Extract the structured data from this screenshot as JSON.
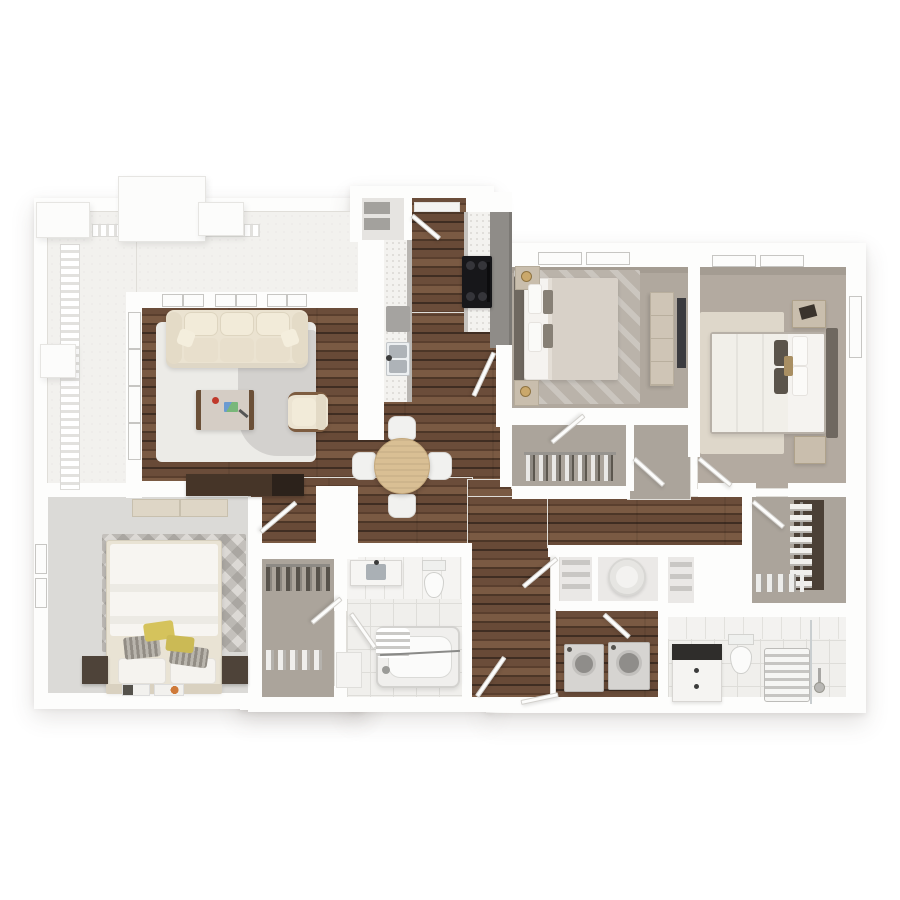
{
  "scene": {
    "title": "3D top-down apartment floor plan render",
    "type": "photoreal-3d-floorplan",
    "canvas": {
      "width": 900,
      "height": 900
    },
    "background": "#ffffff"
  },
  "palette": {
    "wall": "#fdfdfc",
    "wall_edge": "#e0ded9",
    "wood_floor_dark": "#4c3627",
    "wood_floor_mid": "#6b4d3a",
    "wood_floor_light": "#7a5a43",
    "carpet_warm": "#b0a89e",
    "carpet_warm2": "#b3aaa0",
    "carpet_light": "#dbdad7",
    "carpet_closet": "#aba49b",
    "balcony_floor": "#f2f1ee",
    "tile_floor": "#f0efec",
    "tile_line": "#deddd9",
    "accent_wall_gray": "#8f8c88",
    "closet_panel_dark": "#4b4036",
    "sofa_cream": "#ebe3d1",
    "armchair_cream": "#ece4d2",
    "table_wood": "#d9bf94",
    "chair_white": "#f1f1ef",
    "stove_black": "#17171a",
    "counter_white": "#f3f2ef",
    "tv_console_brown": "#463528",
    "bed_white": "#f5f3f0",
    "duvet_taupe": "#d8d1c8",
    "pillow_dark": "#5b544b",
    "pillow_yellow": "#d5c35c",
    "pillow_tan": "#a98f63",
    "nightstand_dark": "#4e4339",
    "nightstand_light": "#c9bead",
    "lamp_gold": "#caa86b",
    "appliance_gray": "#d6d4d1",
    "rug_cream": "#ded7ca",
    "rug_gray": "#bab3aa",
    "rug_living": "#ecebe7",
    "water_heater": "#f3f2f0",
    "door_leaf": "#fcfcfb"
  },
  "rooms": [
    {
      "id": "balcony",
      "name": "balcony",
      "features": [
        "railing",
        "pillars"
      ]
    },
    {
      "id": "living-room",
      "name": "living-room",
      "furniture": [
        "cream-sofa",
        "coffee-table",
        "armchair",
        "tv-console",
        "two-tone-rug"
      ],
      "features": [
        "three-windows-top",
        "tall-window-left"
      ]
    },
    {
      "id": "dining-area",
      "name": "dining-area",
      "furniture": [
        "round-wood-table",
        "four-white-chairs"
      ]
    },
    {
      "id": "kitchen",
      "name": "kitchen",
      "furniture": [
        "left-counter-with-sink",
        "dishwasher",
        "right-counter",
        "black-stove"
      ],
      "features": [
        "gray-accent-wall"
      ]
    },
    {
      "id": "entry",
      "name": "entry",
      "furniture": [
        "pantry-shelves",
        "door-mat"
      ]
    },
    {
      "id": "bedroom-1",
      "name": "bedroom-1",
      "furniture": [
        "queen-bed-taupe-duvet",
        "two-nightstands-with-gold-lamps",
        "dresser",
        "wall-tv",
        "patterned-rug"
      ]
    },
    {
      "id": "closet-1",
      "name": "closet-1",
      "furniture": [
        "hanging-clothes-rod"
      ]
    },
    {
      "id": "bedroom-2",
      "name": "bedroom-2",
      "furniture": [
        "queen-bed-white-duvet",
        "dark-accent-pillows",
        "tan-lumbar-pillow",
        "two-light-nightstands",
        "cream-rug"
      ]
    },
    {
      "id": "walk-in-closet-2",
      "name": "walk-in-closet",
      "furniture": [
        "dark-back-panel",
        "hanging-shirts",
        "shoe-row"
      ]
    },
    {
      "id": "bedroom-3",
      "name": "bedroom-3",
      "furniture": [
        "queen-bed-yellow-pillows",
        "striped-pillows",
        "two-dark-nightstands",
        "light-dresser",
        "triangle-pattern-rug",
        "magazines"
      ]
    },
    {
      "id": "closet-3",
      "name": "closet-3",
      "furniture": [
        "hanging-clothes-rod",
        "shoe-row"
      ]
    },
    {
      "id": "bathroom-1",
      "name": "bathroom-1",
      "furniture": [
        "vanity-sink",
        "toilet",
        "bathtub-with-mat",
        "linen-niche"
      ]
    },
    {
      "id": "bathroom-2",
      "name": "bathroom-2",
      "furniture": [
        "dark-top-vanity",
        "toilet",
        "slatted-shower",
        "shower-head",
        "glass-panel"
      ]
    },
    {
      "id": "laundry-closet",
      "name": "laundry-closet",
      "furniture": [
        "top-load-washer",
        "top-load-dryer"
      ]
    },
    {
      "id": "water-heater-closet",
      "name": "water-heater-closet",
      "furniture": [
        "water-heater-cylinder"
      ]
    },
    {
      "id": "linen-closets",
      "name": "linen-closets",
      "furniture": [
        "shelves"
      ]
    }
  ]
}
